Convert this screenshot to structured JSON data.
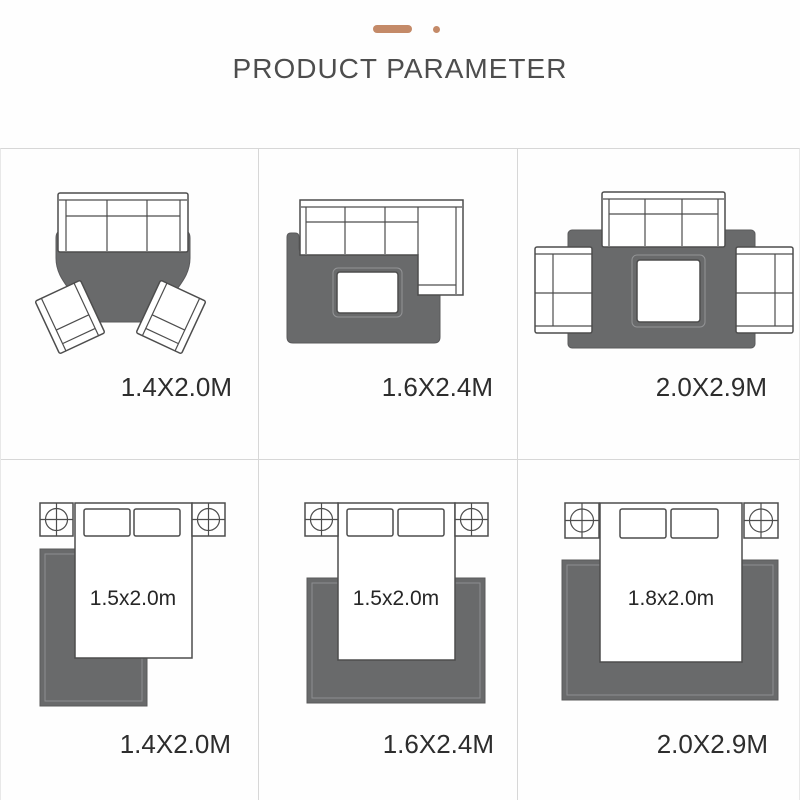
{
  "header": {
    "title": "PRODUCT PARAMETER",
    "accent_color": "#c48a68"
  },
  "colors": {
    "rug_fill": "#696a6b",
    "furniture_outline": "#4d4d4d",
    "grid_line": "#d7d7d7",
    "title_text": "#4d4d4d",
    "label_text": "#2d2d2d"
  },
  "grid": {
    "rows": 2,
    "columns": 3
  },
  "cells": [
    {
      "type": "living-room",
      "rug_size_label": "1.4X2.0M"
    },
    {
      "type": "living-room",
      "rug_size_label": "1.6X2.4M"
    },
    {
      "type": "living-room",
      "rug_size_label": "2.0X2.9M"
    },
    {
      "type": "bedroom",
      "bed_size_label": "1.5x2.0m",
      "rug_size_label": "1.4X2.0M"
    },
    {
      "type": "bedroom",
      "bed_size_label": "1.5x2.0m",
      "rug_size_label": "1.6X2.4M"
    },
    {
      "type": "bedroom",
      "bed_size_label": "1.8x2.0m",
      "rug_size_label": "2.0X2.9M"
    }
  ]
}
